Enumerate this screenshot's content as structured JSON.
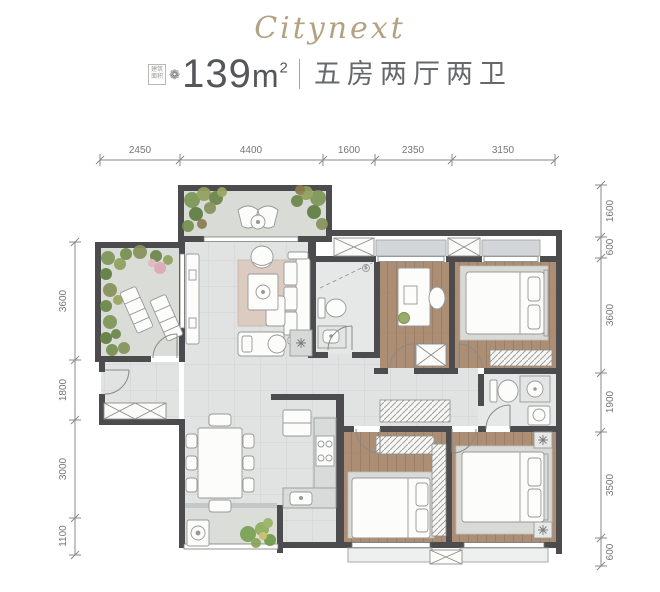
{
  "header": {
    "brand": "Citynext",
    "area_badge": [
      "建筑",
      "面积"
    ],
    "flower_icon": "❁",
    "area_value": "139",
    "area_unit": "m",
    "area_sup": "2",
    "layout_text": "五房两厅两卫"
  },
  "dimensions": {
    "top": [
      "2450",
      "4400",
      "1600",
      "2350",
      "3150"
    ],
    "left": [
      "3600",
      "1800",
      "3000",
      "1100"
    ],
    "right": [
      "1600",
      "600",
      "3600",
      "1900",
      "3500",
      "600"
    ]
  },
  "colors": {
    "brand_gold": "#b3a183",
    "text_dark": "#55565a",
    "wall": "#4c4c4e",
    "wood_floor": "#ac8e75",
    "tile_floor": "#e1e3e2",
    "balcony_floor": "#d8dbd6",
    "plant_green": "#7c9655",
    "accent_pink": "#dda8b7",
    "dimension_text": "#757575"
  }
}
